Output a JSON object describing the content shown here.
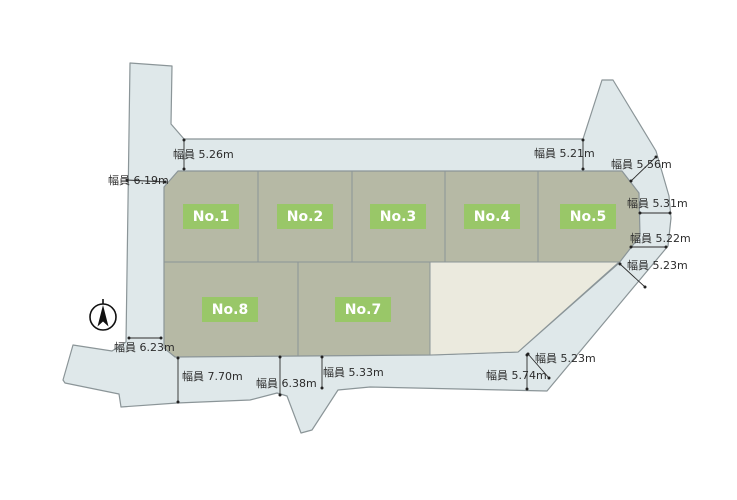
{
  "map": {
    "kind": "land-subdivision-plot-map",
    "colors": {
      "road": "#dfe8ea",
      "parcel": "#b6b9a5",
      "vacant_lot": "#ebeade",
      "lot_label_bg": "#99c768",
      "lot_label_text": "#ffffff",
      "outline": "#8b9598",
      "dimension_text": "#2c2c2c",
      "compass": "#111111",
      "background": "#ffffff"
    },
    "lots": [
      {
        "label": "No.1"
      },
      {
        "label": "No.2"
      },
      {
        "label": "No.3"
      },
      {
        "label": "No.4"
      },
      {
        "label": "No.5"
      },
      {
        "label": "No.7"
      },
      {
        "label": "No.8"
      }
    ],
    "measurements": [
      {
        "label": "幅員 5.26m"
      },
      {
        "label": "幅員 5.21m"
      },
      {
        "label": "幅員 5.56m"
      },
      {
        "label": "幅員 5.31m"
      },
      {
        "label": "幅員 5.22m"
      },
      {
        "label": "幅員 5.23m"
      },
      {
        "label": "幅員 5.23m"
      },
      {
        "label": "幅員 5.74m"
      },
      {
        "label": "幅員 5.33m"
      },
      {
        "label": "幅員 6.38m"
      },
      {
        "label": "幅員 7.70m"
      },
      {
        "label": "幅員 6.23m"
      },
      {
        "label": "幅員 6.19m"
      }
    ]
  }
}
